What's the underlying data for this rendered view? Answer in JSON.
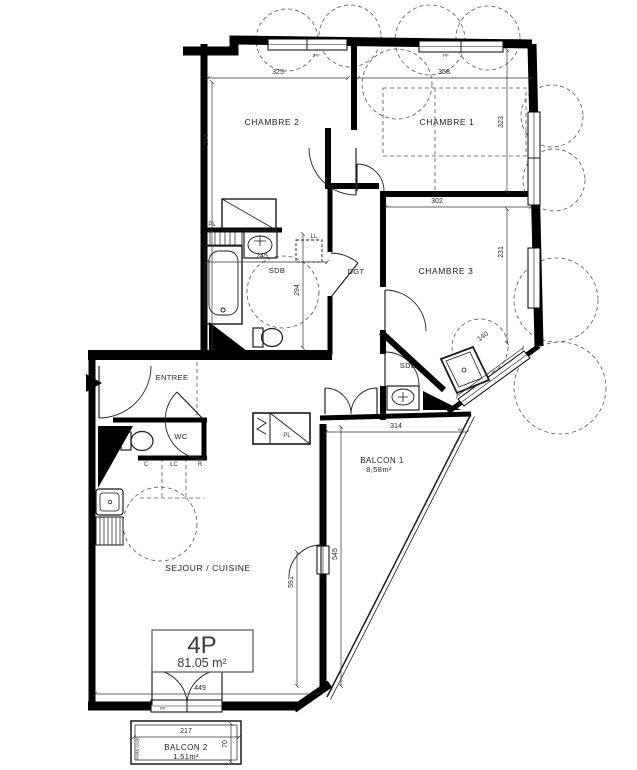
{
  "unit": {
    "type": "4P",
    "area": "81.05 m²"
  },
  "rooms": {
    "chambre2": "CHAMBRE 2",
    "chambre1": "CHAMBRE 1",
    "chambre3": "CHAMBRE 3",
    "sdb": "SDB",
    "dgt": "DGT",
    "sde": "SDE",
    "entree": "ENTREE",
    "wc": "WC",
    "sejour_cuisine": "SEJOUR / CUISINE",
    "balcon1": "BALCON 1",
    "balcon1_area": "8,58m²",
    "balcon2": "BALCON 2",
    "balcon2_area": "1,51m²"
  },
  "dims": {
    "chambre2_w": "325",
    "chambre2_h": "374",
    "chambre1_w": "358",
    "chambre1_h": "323",
    "chambre3_w": "302",
    "chambre3_h": "231",
    "sdb_w": "245",
    "sdb_h": "294",
    "sde_window": "140",
    "balcon1_w": "314",
    "balcon1_h": "545",
    "sejour_w": "449",
    "sejour_h": "591",
    "balcon2_w": "217",
    "balcon2_d": "70"
  },
  "tags": {
    "pf": "PF",
    "pl": "PL",
    "ll": "LL",
    "c": "C",
    "lc": "LC",
    "r": "R",
    "ec": "ec",
    "pare_vue": "PARE-VUE"
  }
}
